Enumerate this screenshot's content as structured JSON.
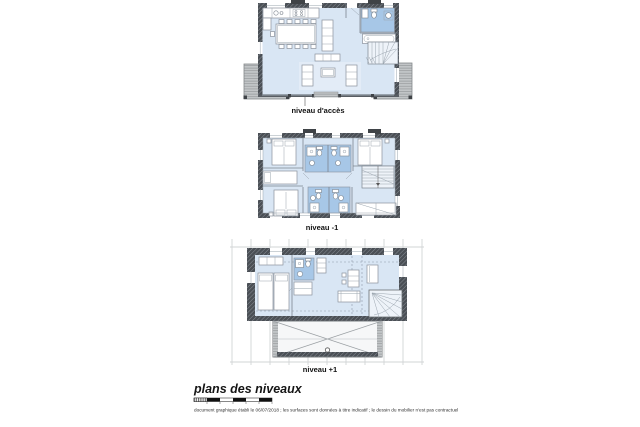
{
  "document": {
    "title": "plans des niveaux",
    "footnote": "document graphique établi le 06/07/2018 ; les surfaces sont données à titre indicatif ; le dessin du mobilier n'est pas contractuel"
  },
  "plans": [
    {
      "id": "niveau-acces",
      "label": "niveau d'accès"
    },
    {
      "id": "niveau-moins-1",
      "label": "niveau -1"
    },
    {
      "id": "niveau-plus-1",
      "label": "niveau +1"
    }
  ],
  "colors": {
    "floor": "#d9e6f4",
    "wet_room": "#a7c7e7",
    "rug": "#e3ecf7",
    "stair_fill": "#eef3f9",
    "wall": "#4a4f55",
    "terrace": "#c2c5c7",
    "furniture_line": "#8a929c",
    "label_text": "#111111"
  }
}
